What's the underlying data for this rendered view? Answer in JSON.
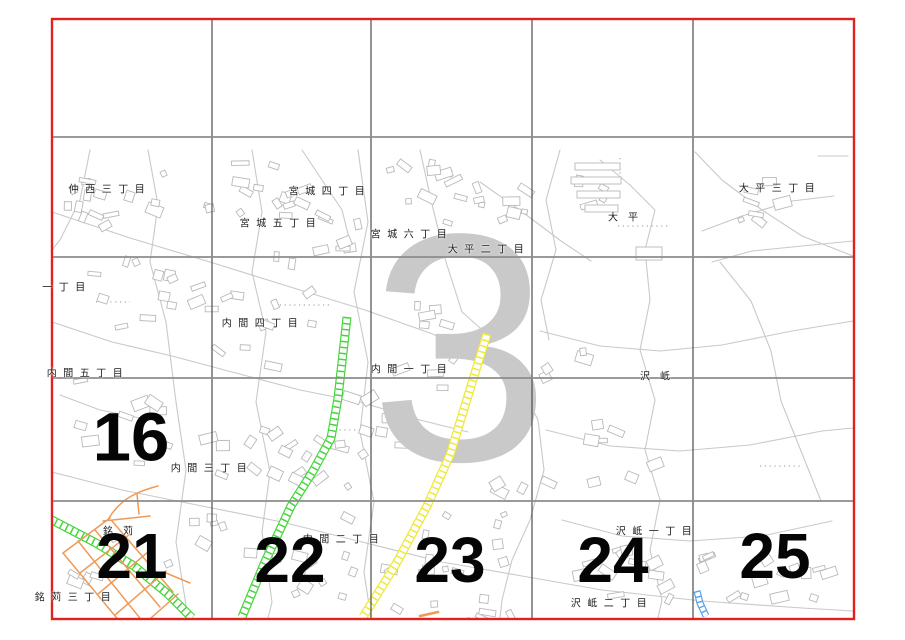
{
  "watermark": {
    "text": "3"
  },
  "sheet_numbers": {
    "items": [
      {
        "text": "16"
      },
      {
        "text": "21"
      },
      {
        "text": "22"
      },
      {
        "text": "23"
      },
      {
        "text": "24"
      },
      {
        "text": "25"
      }
    ]
  },
  "labels": {
    "items": [
      {
        "text": "仲西三丁目"
      },
      {
        "text": "宮城四丁目"
      },
      {
        "text": "宮城五丁目"
      },
      {
        "text": "宮城六丁目"
      },
      {
        "text": "大平二丁目"
      },
      {
        "text": "大平"
      },
      {
        "text": "大平三丁目"
      },
      {
        "text": "一丁目"
      },
      {
        "text": "内間四丁目"
      },
      {
        "text": "内間五丁目"
      },
      {
        "text": "内間一丁目"
      },
      {
        "text": "沢岻"
      },
      {
        "text": "内間三丁目"
      },
      {
        "text": "銘苅"
      },
      {
        "text": "内間二丁目"
      },
      {
        "text": "沢岻一丁目"
      },
      {
        "text": "銘苅三丁目"
      },
      {
        "text": "沢岻二丁目"
      }
    ]
  },
  "colors": {
    "border-red": "#e32020",
    "grid-h": "#8c8c8c",
    "grid-v": "#4d4d4d",
    "map-line": "#c9c9c9",
    "building-line": "#b9b9b9",
    "watermark-gray": "#c9c9c9",
    "road-green": "#46d53c",
    "road-yellow": "#eee83a",
    "road-orange": "#ef9a57",
    "road-blue": "#4f9be8",
    "label-ink": "#1c1c1c",
    "number-ink": "#050505"
  }
}
